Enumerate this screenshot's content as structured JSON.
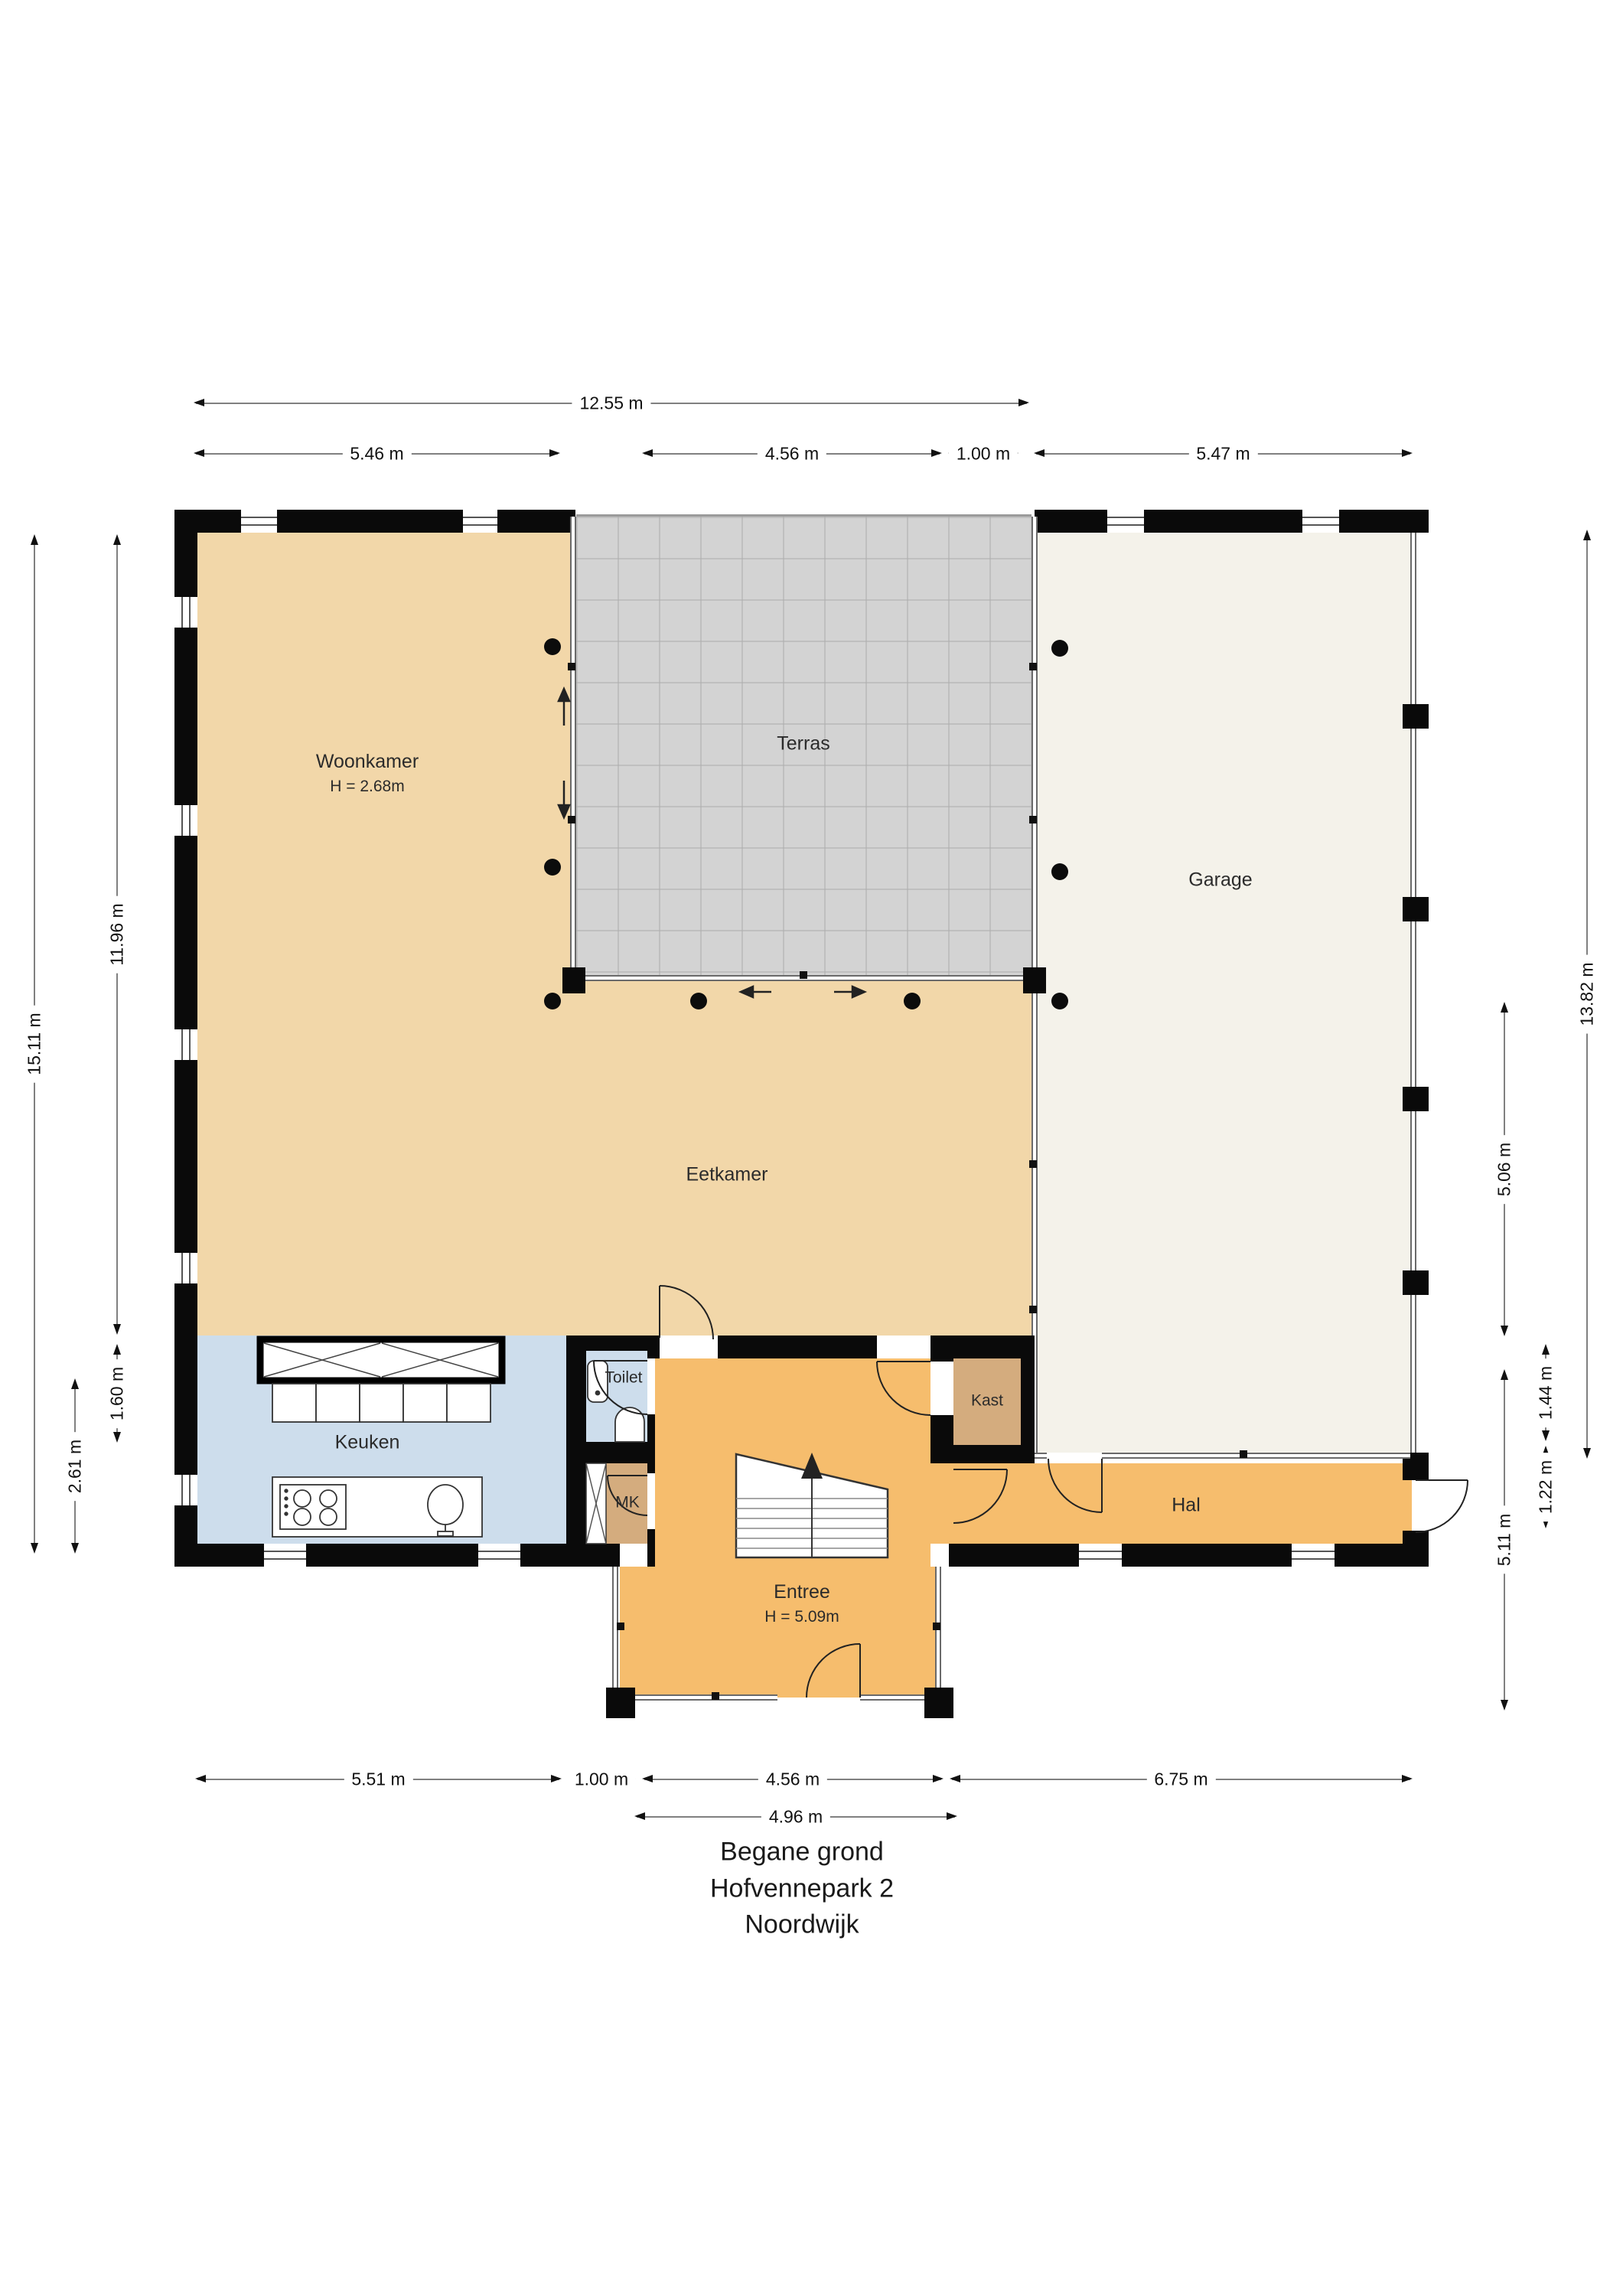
{
  "title": [
    "Begane grond",
    "Hofvennepark 2",
    "Noordwijk"
  ],
  "rooms": {
    "woonkamer": {
      "name": "Woonkamer",
      "note": "H = 2.68m"
    },
    "terras": {
      "name": "Terras"
    },
    "garage": {
      "name": "Garage"
    },
    "eetkamer": {
      "name": "Eetkamer"
    },
    "keuken": {
      "name": "Keuken"
    },
    "toilet": {
      "name": "Toilet"
    },
    "mk": {
      "name": "MK"
    },
    "kast": {
      "name": "Kast"
    },
    "hal": {
      "name": "Hal"
    },
    "entree": {
      "name": "Entree",
      "note": "H = 5.09m"
    }
  },
  "dimensions": {
    "top": [
      "12.55 m",
      "5.46 m",
      "4.56 m",
      "1.00 m",
      "5.47 m"
    ],
    "bottom": [
      "5.51 m",
      "1.00 m",
      "4.56 m",
      "6.75 m",
      "4.96 m"
    ],
    "left": [
      "15.11 m",
      "11.96 m",
      "1.60 m",
      "2.61 m"
    ],
    "right": [
      "13.82 m",
      "5.06 m",
      "1.44 m",
      "1.22 m",
      "5.11 m"
    ]
  },
  "colors": {
    "beige": "#f2d7a9",
    "terras": "#d3d3d3",
    "garage": "#f4f2ea",
    "blue": "#cdddec",
    "orange": "#f6bd6d",
    "tan": "#d4ac7e",
    "wall": "#0a0a0a",
    "dimline": "#808080",
    "dimtext": "#111111"
  }
}
